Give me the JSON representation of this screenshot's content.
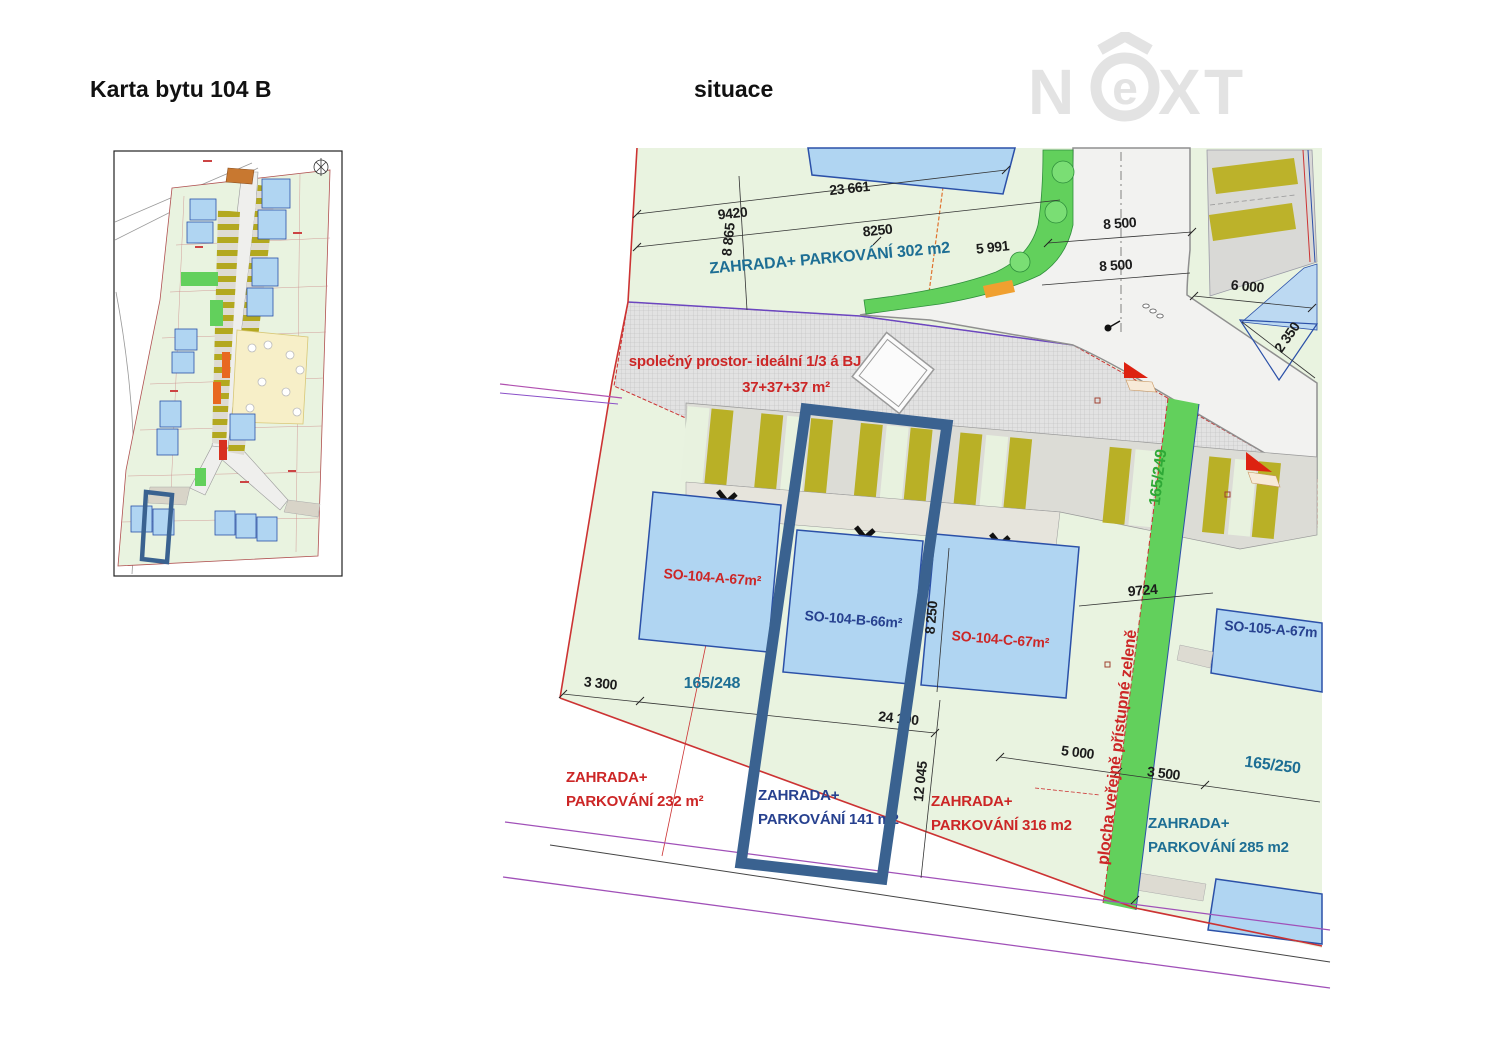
{
  "header": {
    "card_title": "Karta bytu 104 B",
    "drawing_title": "situace"
  },
  "logo": {
    "n": "N",
    "e": "e",
    "x": "X",
    "t": "T"
  },
  "colors": {
    "logo_gray": "#e3e3e3",
    "parcel_fill": "#e9f3e0",
    "building_fill": "#b0d5f2",
    "building_stroke": "#2b50a8",
    "public_green": "#62d05c",
    "parking_olive": "#b9b026",
    "boundary_red": "#cc3333",
    "highlight_blue": "#3a6290",
    "label_red": "#cc2626",
    "label_teal": "#1d6e94",
    "label_navy": "#27418f",
    "label_green": "#2ea836"
  },
  "plan": {
    "dims": {
      "d23661": "23 661",
      "d9420": "9420",
      "d8865": "8 865",
      "d8250top": "8250",
      "d5991": "5 991",
      "d8500a": "8 500",
      "d8500b": "8 500",
      "d6000": "6 000",
      "d2350": "2 350",
      "d8250v": "8 250",
      "d9724": "9724",
      "d3300": "3 300",
      "d24100": "24 100",
      "d12045": "12 045",
      "d5000": "5 000",
      "d3500": "3 500"
    },
    "parcels": {
      "p248": "165/248",
      "p249": "165/249",
      "p250": "165/250"
    },
    "areas": {
      "z302": "ZAHRADA+ PARKOVÁNÍ 302 m2",
      "common1": "společný prostor- ideální 1/3 á BJ",
      "common2": "37+37+37 m²",
      "z232a": "ZAHRADA+",
      "z232b": "PARKOVÁNÍ 232 m²",
      "z141a": "ZAHRADA+",
      "z141b": "PARKOVÁNÍ 141 m2",
      "z316a": "ZAHRADA+",
      "z316b": "PARKOVÁNÍ 316 m2",
      "z285a": "ZAHRADA+",
      "z285b": "PARKOVÁNÍ 285 m2",
      "green_strip": "plocha veřejně přístupné zeleně"
    },
    "buildings": {
      "a": "SO-104-A-67m²",
      "b": "SO-104-B-66m²",
      "c": "SO-104-C-67m²",
      "d": "SO-105-A-67m"
    }
  }
}
